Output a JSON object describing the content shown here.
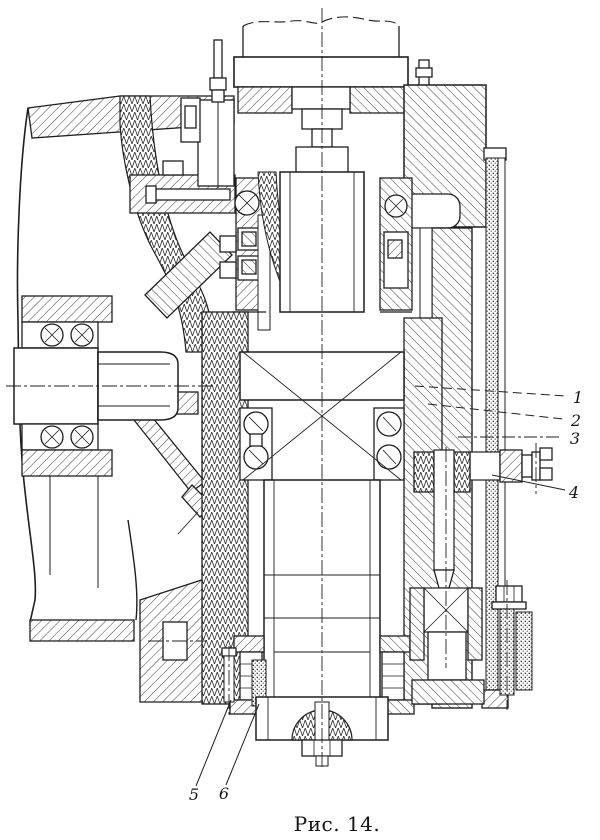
{
  "figure": {
    "caption": "Рис. 14.",
    "ink_color": "#1f1f1f",
    "paper_color": "#ffffff",
    "callouts": [
      {
        "label": "1"
      },
      {
        "label": "2"
      },
      {
        "label": "3"
      },
      {
        "label": "4"
      },
      {
        "label": "5"
      },
      {
        "label": "6"
      }
    ]
  }
}
